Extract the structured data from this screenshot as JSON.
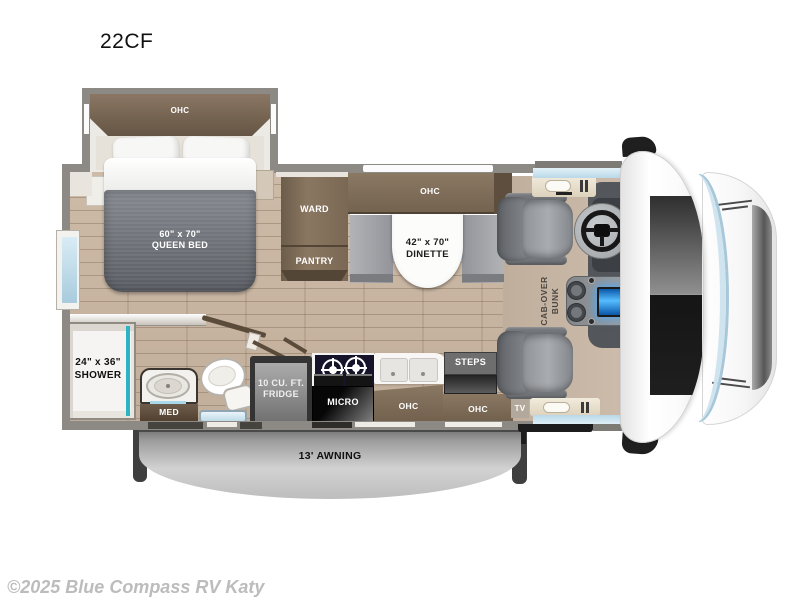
{
  "title": "22CF",
  "watermark": "©2025 Blue Compass RV Katy",
  "labels": {
    "bedroom_ohc": "OHC",
    "bed_size": "60\" x 70\"",
    "bed_name": "QUEEN BED",
    "ward": "WARD",
    "pantry": "PANTRY",
    "dinette_ohc": "OHC",
    "dinette_size": "42\" x 70\"",
    "dinette_name": "DINETTE",
    "shower_size": "24\" x 36\"",
    "shower_name": "SHOWER",
    "med": "MED",
    "fridge_size": "10 CU. FT.",
    "fridge_name": "FRIDGE",
    "micro": "MICRO",
    "kitchen_ohc": "OHC",
    "entry_ohc": "OHC",
    "steps": "STEPS",
    "tv": "TV",
    "bunk_line1": "CAB-OVER",
    "bunk_line2": "BUNK",
    "awning": "13' AWNING"
  },
  "colors": {
    "wall_gray": "#8d8a85",
    "floor_wood": "#c9b6a3",
    "cabinet_brown": "#7d6b58",
    "accent_teal": "#2db4c4",
    "window_blue": "#cfe6f2",
    "screen_blue": "#2f8fe0",
    "awning_gray": "#b8b8b8"
  }
}
